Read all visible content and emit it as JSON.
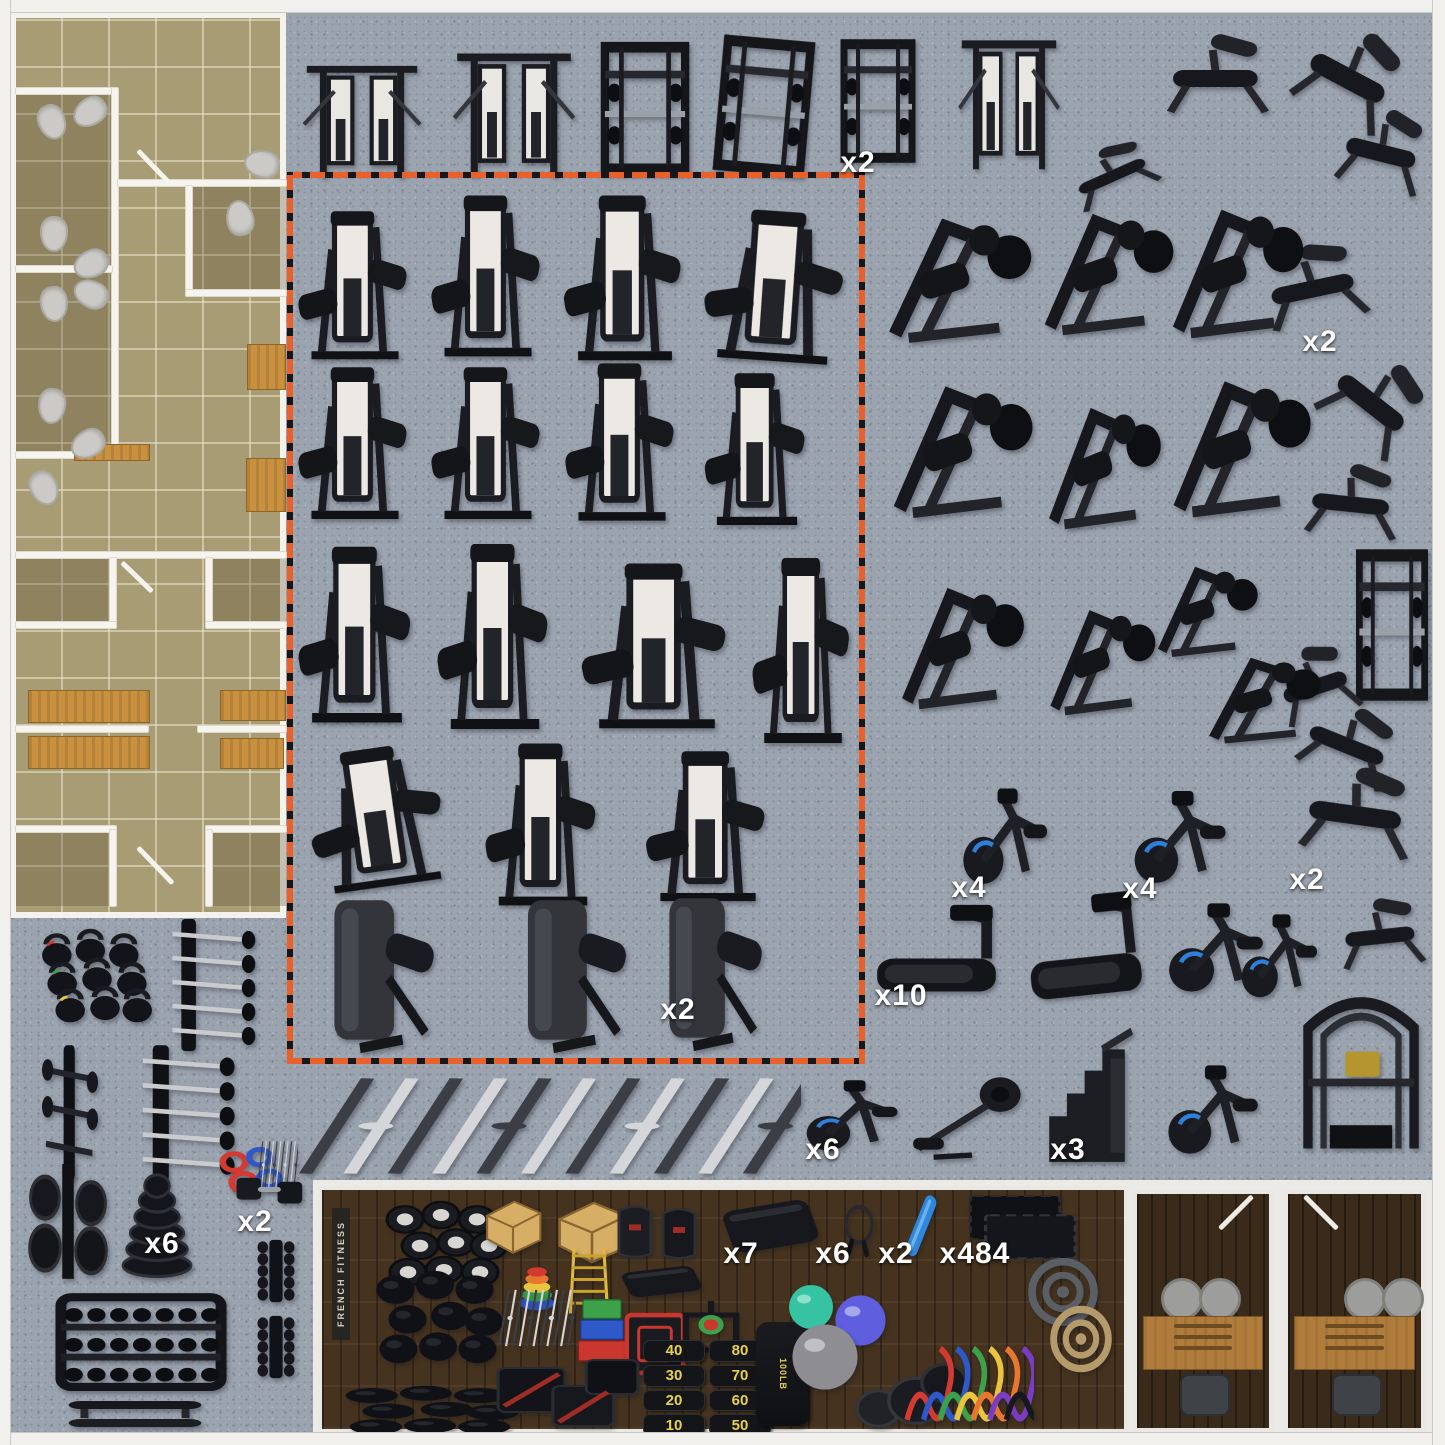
{
  "colors": {
    "carpet": "#9ba3af",
    "plan_floor": "#a89c75",
    "wall": "#f4f2ec",
    "wood_bench": "#c9913f",
    "zone_orange": "#e8612a",
    "strip_wood": "#46331f",
    "label_text": "#ffffff",
    "bike_accent": "#2e7fd9",
    "stack_white": "#eceae6"
  },
  "highlight_zone": {
    "x": 287,
    "y": 172,
    "w": 578,
    "h": 892
  },
  "bottom_strip": {
    "x": 318,
    "y": 1186,
    "w": 810,
    "h": 247,
    "brand": "FRENCH FITNESS"
  },
  "punching_bag_label": "100LB",
  "sandbags": {
    "left": [
      "40",
      "30",
      "20",
      "10"
    ],
    "right": [
      "80",
      "70",
      "60",
      "50"
    ]
  },
  "labels": [
    {
      "t": "x2",
      "x": 858,
      "y": 163
    },
    {
      "t": "x2",
      "x": 1320,
      "y": 342
    },
    {
      "t": "x4",
      "x": 969,
      "y": 888
    },
    {
      "t": "x4",
      "x": 1140,
      "y": 889
    },
    {
      "t": "x2",
      "x": 1307,
      "y": 880
    },
    {
      "t": "x2",
      "x": 678,
      "y": 1010
    },
    {
      "t": "x10",
      "x": 901,
      "y": 996
    },
    {
      "t": "x6",
      "x": 823,
      "y": 1150
    },
    {
      "t": "x3",
      "x": 1068,
      "y": 1150
    },
    {
      "t": "x6",
      "x": 162,
      "y": 1244
    },
    {
      "t": "x2",
      "x": 255,
      "y": 1222
    },
    {
      "t": "x7",
      "x": 741,
      "y": 1254
    },
    {
      "t": "x6",
      "x": 833,
      "y": 1254
    },
    {
      "t": "x2",
      "x": 896,
      "y": 1254
    },
    {
      "t": "x484",
      "x": 975,
      "y": 1254
    }
  ],
  "floorplan": {
    "rooms": [
      {
        "x": 16,
        "y": 94,
        "w": 96,
        "h": 172
      },
      {
        "x": 16,
        "y": 272,
        "w": 96,
        "h": 180
      },
      {
        "x": 192,
        "y": 186,
        "w": 94,
        "h": 104
      },
      {
        "x": 16,
        "y": 558,
        "w": 94,
        "h": 64
      },
      {
        "x": 212,
        "y": 558,
        "w": 74,
        "h": 64
      },
      {
        "x": 16,
        "y": 832,
        "w": 94,
        "h": 74
      },
      {
        "x": 212,
        "y": 832,
        "w": 74,
        "h": 74
      }
    ],
    "walls": [
      {
        "x": 16,
        "y": 88,
        "w": 100,
        "h": 6
      },
      {
        "x": 112,
        "y": 88,
        "w": 6,
        "h": 372
      },
      {
        "x": 118,
        "y": 180,
        "w": 168,
        "h": 6
      },
      {
        "x": 186,
        "y": 186,
        "w": 6,
        "h": 110
      },
      {
        "x": 186,
        "y": 290,
        "w": 100,
        "h": 6
      },
      {
        "x": 16,
        "y": 266,
        "w": 96,
        "h": 6
      },
      {
        "x": 16,
        "y": 452,
        "w": 102,
        "h": 6
      },
      {
        "x": 16,
        "y": 552,
        "w": 270,
        "h": 6
      },
      {
        "x": 110,
        "y": 558,
        "w": 6,
        "h": 70
      },
      {
        "x": 16,
        "y": 622,
        "w": 100,
        "h": 6
      },
      {
        "x": 206,
        "y": 558,
        "w": 6,
        "h": 70
      },
      {
        "x": 206,
        "y": 622,
        "w": 80,
        "h": 6
      },
      {
        "x": 16,
        "y": 726,
        "w": 132,
        "h": 6
      },
      {
        "x": 198,
        "y": 726,
        "w": 88,
        "h": 6
      },
      {
        "x": 16,
        "y": 826,
        "w": 100,
        "h": 6
      },
      {
        "x": 110,
        "y": 830,
        "w": 6,
        "h": 76
      },
      {
        "x": 206,
        "y": 826,
        "w": 80,
        "h": 6
      },
      {
        "x": 206,
        "y": 830,
        "w": 6,
        "h": 76
      }
    ],
    "benches": [
      {
        "x": 247,
        "y": 344,
        "w": 37,
        "h": 44
      },
      {
        "x": 246,
        "y": 458,
        "w": 38,
        "h": 52
      },
      {
        "x": 74,
        "y": 444,
        "w": 74,
        "h": 15
      },
      {
        "x": 28,
        "y": 690,
        "w": 120,
        "h": 31
      },
      {
        "x": 220,
        "y": 690,
        "w": 64,
        "h": 29
      },
      {
        "x": 28,
        "y": 736,
        "w": 120,
        "h": 31
      },
      {
        "x": 220,
        "y": 738,
        "w": 62,
        "h": 29
      }
    ],
    "toilets": [
      {
        "x": 38,
        "y": 104,
        "r": -20
      },
      {
        "x": 76,
        "y": 94,
        "r": 55
      },
      {
        "x": 248,
        "y": 146,
        "r": 100
      },
      {
        "x": 226,
        "y": 200,
        "r": 170
      },
      {
        "x": 40,
        "y": 216,
        "r": 0
      },
      {
        "x": 77,
        "y": 246,
        "r": 65
      },
      {
        "x": 40,
        "y": 286,
        "r": -5
      },
      {
        "x": 77,
        "y": 276,
        "r": 115
      },
      {
        "x": 38,
        "y": 388,
        "r": 5
      },
      {
        "x": 74,
        "y": 426,
        "r": 60
      },
      {
        "x": 30,
        "y": 470,
        "r": -25
      }
    ],
    "doors": [
      {
        "x": 138,
        "y": 148,
        "len": 46,
        "rot": 46
      },
      {
        "x": 122,
        "y": 560,
        "len": 42,
        "rot": 44
      },
      {
        "x": 138,
        "y": 845,
        "len": 50,
        "rot": 46
      }
    ]
  },
  "offices": [
    {
      "x": 1133,
      "y": 1190,
      "w": 140,
      "h": 242,
      "flip": false
    },
    {
      "x": 1284,
      "y": 1190,
      "w": 141,
      "h": 242,
      "flip": true
    }
  ],
  "equipment": [
    {
      "n": "functional-trainer",
      "k": "ftrainer",
      "x": 293,
      "y": 50,
      "w": 138,
      "h": 138
    },
    {
      "n": "dual-stack-functional-trainer",
      "k": "ftrainer",
      "x": 443,
      "y": 36,
      "w": 142,
      "h": 152
    },
    {
      "n": "power-rack",
      "k": "rack",
      "x": 586,
      "y": 32,
      "w": 118,
      "h": 152
    },
    {
      "n": "smith-machine",
      "k": "rack",
      "x": 703,
      "y": 28,
      "w": 122,
      "h": 156,
      "r": 5
    },
    {
      "n": "half-rack-plate-storage",
      "k": "rack",
      "x": 828,
      "y": 30,
      "w": 100,
      "h": 142
    },
    {
      "n": "cable-jungle",
      "k": "ftrainer",
      "x": 950,
      "y": 22,
      "w": 118,
      "h": 160
    },
    {
      "n": "flat-decline-bench",
      "k": "bench",
      "x": 1058,
      "y": 142,
      "w": 112,
      "h": 66,
      "r": -24
    },
    {
      "n": "ghd-machine",
      "k": "bench",
      "x": 1152,
      "y": 28,
      "w": 132,
      "h": 100
    },
    {
      "n": "ab-crunch-bench",
      "k": "bench",
      "x": 1287,
      "y": 20,
      "w": 126,
      "h": 118,
      "r": 28
    },
    {
      "n": "adjustable-incline-bench",
      "k": "bench",
      "x": 1328,
      "y": 102,
      "w": 110,
      "h": 102,
      "r": 14
    },
    {
      "n": "fid-bench",
      "k": "bench",
      "x": 1250,
      "y": 238,
      "w": 130,
      "h": 100,
      "r": -12
    },
    {
      "n": "decline-ab-bench",
      "k": "bench",
      "x": 1312,
      "y": 348,
      "w": 122,
      "h": 112,
      "r": 38
    },
    {
      "n": "flat-utility-bench",
      "k": "bench",
      "x": 1293,
      "y": 458,
      "w": 120,
      "h": 92,
      "r": 6
    },
    {
      "n": "power-tower",
      "k": "rack",
      "x": 1344,
      "y": 538,
      "w": 96,
      "h": 174
    },
    {
      "n": "roman-chair",
      "k": "bench",
      "x": 1266,
      "y": 640,
      "w": 102,
      "h": 92,
      "r": -18
    },
    {
      "n": "incline-bench",
      "k": "bench",
      "x": 1288,
      "y": 700,
      "w": 122,
      "h": 92,
      "r": 22
    },
    {
      "n": "olympic-flat-bench",
      "k": "bench",
      "x": 1286,
      "y": 760,
      "w": 144,
      "h": 110,
      "r": 8
    },
    {
      "n": "seated-utility-bench",
      "k": "bench",
      "x": 1328,
      "y": 893,
      "w": 108,
      "h": 86,
      "r": -6
    },
    {
      "n": "iso-lateral-leg-press",
      "k": "plate",
      "x": 875,
      "y": 190,
      "w": 168,
      "h": 168
    },
    {
      "n": "linear-leg-press",
      "k": "plate",
      "x": 1032,
      "y": 186,
      "w": 152,
      "h": 164
    },
    {
      "n": "hack-squat-machine",
      "k": "plate",
      "x": 1160,
      "y": 180,
      "w": 154,
      "h": 174
    },
    {
      "n": "belt-squat-machine",
      "k": "plate",
      "x": 880,
      "y": 356,
      "w": 164,
      "h": 178
    },
    {
      "n": "iso-lateral-row-machine",
      "k": "plate",
      "x": 1038,
      "y": 380,
      "w": 132,
      "h": 164
    },
    {
      "n": "iso-lateral-bench-press",
      "k": "plate",
      "x": 1160,
      "y": 350,
      "w": 162,
      "h": 184
    },
    {
      "n": "pendulum-squat",
      "k": "plate",
      "x": 890,
      "y": 560,
      "w": 144,
      "h": 164
    },
    {
      "n": "seated-calf-machine",
      "k": "plate",
      "x": 1040,
      "y": 586,
      "w": 124,
      "h": 142
    },
    {
      "n": "t-bar-row",
      "k": "plate",
      "x": 1148,
      "y": 546,
      "w": 118,
      "h": 122
    },
    {
      "n": "glute-drive-machine",
      "k": "plate",
      "x": 1198,
      "y": 638,
      "w": 132,
      "h": 116
    },
    {
      "n": "upright-bike",
      "k": "bike",
      "x": 948,
      "y": 772,
      "w": 118,
      "h": 138
    },
    {
      "n": "recumbent-bike",
      "k": "bike",
      "x": 1118,
      "y": 775,
      "w": 128,
      "h": 133
    },
    {
      "n": "treadmill",
      "k": "tread",
      "x": 862,
      "y": 900,
      "w": 152,
      "h": 122
    },
    {
      "n": "curved-treadmill",
      "k": "tread",
      "x": 1015,
      "y": 890,
      "w": 142,
      "h": 140,
      "r": -6
    },
    {
      "n": "seated-climber",
      "k": "bike",
      "x": 1152,
      "y": 888,
      "w": 132,
      "h": 128
    },
    {
      "n": "spin-bike",
      "k": "bike",
      "x": 1228,
      "y": 900,
      "w": 106,
      "h": 120
    },
    {
      "n": "elliptical-trainer",
      "k": "bike",
      "x": 790,
      "y": 1068,
      "w": 128,
      "h": 102
    },
    {
      "n": "air-rower",
      "k": "rower",
      "x": 908,
      "y": 1060,
      "w": 128,
      "h": 108
    },
    {
      "n": "stair-climber",
      "k": "climber",
      "x": 1028,
      "y": 1022,
      "w": 118,
      "h": 152
    },
    {
      "n": "air-bike",
      "k": "bike",
      "x": 1152,
      "y": 1050,
      "w": 126,
      "h": 128
    },
    {
      "n": "ff-multi-rig",
      "k": "rig",
      "x": 1283,
      "y": 970,
      "w": 156,
      "h": 194
    },
    {
      "n": "seated-row-machine",
      "k": "sel",
      "x": 291,
      "y": 208,
      "w": 128,
      "h": 160
    },
    {
      "n": "standing-leg-curl-machine",
      "k": "sel",
      "x": 424,
      "y": 192,
      "w": 128,
      "h": 174
    },
    {
      "n": "shoulder-press-machine",
      "k": "sel",
      "x": 556,
      "y": 192,
      "w": 138,
      "h": 178
    },
    {
      "n": "leg-extension-machine",
      "k": "sel",
      "x": 696,
      "y": 208,
      "w": 162,
      "h": 162,
      "r": 4
    },
    {
      "n": "pec-fly-machine",
      "k": "sel",
      "x": 291,
      "y": 364,
      "w": 128,
      "h": 164
    },
    {
      "n": "hip-adduction-machine",
      "k": "sel",
      "x": 424,
      "y": 364,
      "w": 128,
      "h": 164
    },
    {
      "n": "lat-pulldown-machine",
      "k": "sel",
      "x": 558,
      "y": 360,
      "w": 128,
      "h": 170
    },
    {
      "n": "seated-dip-machine",
      "k": "sel",
      "x": 698,
      "y": 370,
      "w": 118,
      "h": 164
    },
    {
      "n": "multi-press-machine",
      "k": "sel",
      "x": 291,
      "y": 543,
      "w": 132,
      "h": 190
    },
    {
      "n": "glute-kickback-machine",
      "k": "sel",
      "x": 430,
      "y": 540,
      "w": 130,
      "h": 200
    },
    {
      "n": "ab-crunch-machine",
      "k": "sel",
      "x": 572,
      "y": 560,
      "w": 170,
      "h": 178
    },
    {
      "n": "dip-chin-assist-machine",
      "k": "sel",
      "x": 746,
      "y": 554,
      "w": 114,
      "h": 200
    },
    {
      "n": "seated-leg-press-machine",
      "k": "sel",
      "x": 300,
      "y": 745,
      "w": 158,
      "h": 150,
      "r": -8
    },
    {
      "n": "back-extension-machine",
      "k": "sel",
      "x": 478,
      "y": 740,
      "w": 130,
      "h": 175
    },
    {
      "n": "preacher-curl-machine",
      "k": "sel",
      "x": 638,
      "y": 748,
      "w": 140,
      "h": 162
    },
    {
      "n": "converging-chest-press",
      "k": "shroud",
      "x": 306,
      "y": 890,
      "w": 142,
      "h": 170
    },
    {
      "n": "pec-dec-machine",
      "k": "shroud",
      "x": 500,
      "y": 890,
      "w": 140,
      "h": 170
    },
    {
      "n": "tricep-extension-machine",
      "k": "shroud",
      "x": 643,
      "y": 888,
      "w": 132,
      "h": 170
    },
    {
      "n": "kettlebell-set",
      "k": "kbell",
      "x": 30,
      "y": 920,
      "w": 134,
      "h": 110
    },
    {
      "n": "fixed-barbell-rack",
      "k": "rackbars",
      "x": 150,
      "y": 910,
      "w": 112,
      "h": 150
    },
    {
      "n": "accessory-tree",
      "k": "tree",
      "x": 30,
      "y": 1036,
      "w": 80,
      "h": 154
    },
    {
      "n": "ez-barbell-rack",
      "k": "rackbars",
      "x": 118,
      "y": 1036,
      "w": 124,
      "h": 154
    },
    {
      "n": "plate-tree",
      "k": "ptree",
      "x": 20,
      "y": 1150,
      "w": 96,
      "h": 140
    },
    {
      "n": "bumper-plate-stack",
      "k": "pstack",
      "x": 112,
      "y": 1160,
      "w": 90,
      "h": 124
    },
    {
      "n": "barbell-collars",
      "k": "collars",
      "x": 210,
      "y": 1144,
      "w": 80,
      "h": 60
    },
    {
      "n": "cable-attachments",
      "k": "bars",
      "x": 256,
      "y": 1138,
      "w": 42,
      "h": 54
    },
    {
      "n": "hex-dumbbell-pair",
      "k": "hexdb",
      "x": 230,
      "y": 1160,
      "w": 82,
      "h": 64
    },
    {
      "n": "vertical-dumbbell-rack",
      "k": "dbtower",
      "x": 243,
      "y": 1234,
      "w": 66,
      "h": 74
    },
    {
      "n": "vertical-dumbbell-rack-2",
      "k": "dbtower",
      "x": 243,
      "y": 1310,
      "w": 66,
      "h": 74
    },
    {
      "n": "three-tier-dumbbell-rack",
      "k": "dbrack",
      "x": 50,
      "y": 1270,
      "w": 182,
      "h": 136
    },
    {
      "n": "flat-bench-stack",
      "k": "benchpair",
      "x": 56,
      "y": 1390,
      "w": 158,
      "h": 50
    },
    {
      "n": "specialty-barbell-set",
      "k": "bars",
      "x": 285,
      "y": 1072,
      "w": 516,
      "h": 108
    },
    {
      "n": "medicine-ball-pyramid",
      "k": "ballsm",
      "x": 372,
      "y": 1193,
      "w": 150,
      "h": 110
    },
    {
      "n": "slam-ball-pyramid",
      "k": "ballsd",
      "x": 362,
      "y": 1260,
      "w": 152,
      "h": 114
    },
    {
      "n": "wall-ball-row",
      "k": "ballsd",
      "x": 326,
      "y": 1380,
      "w": 208,
      "h": 60
    },
    {
      "n": "wooden-plyo-box",
      "k": "woodbox",
      "x": 477,
      "y": 1194,
      "w": 72,
      "h": 64
    },
    {
      "n": "jerk-blocks",
      "k": "woodbox",
      "x": 547,
      "y": 1194,
      "w": 90,
      "h": 74
    },
    {
      "n": "weighted-vests",
      "k": "vests",
      "x": 607,
      "y": 1198,
      "w": 100,
      "h": 66
    },
    {
      "n": "yoga-mats",
      "k": "mat",
      "x": 716,
      "y": 1190,
      "w": 110,
      "h": 74
    },
    {
      "n": "jump-ropes",
      "k": "jrope",
      "x": 834,
      "y": 1196,
      "w": 50,
      "h": 68
    },
    {
      "n": "foam-roller",
      "k": "roller",
      "x": 898,
      "y": 1194,
      "w": 54,
      "h": 72
    },
    {
      "n": "rubber-floor-tiles",
      "k": "tiles",
      "x": 960,
      "y": 1188,
      "w": 128,
      "h": 80
    },
    {
      "n": "agility-cones",
      "k": "cones",
      "x": 508,
      "y": 1258,
      "w": 58,
      "h": 58
    },
    {
      "n": "agility-ladder",
      "k": "ladder",
      "x": 558,
      "y": 1244,
      "w": 62,
      "h": 74
    },
    {
      "n": "aerobic-stepper",
      "k": "mat",
      "x": 616,
      "y": 1260,
      "w": 92,
      "h": 44
    },
    {
      "n": "farmer-carry-handles",
      "k": "bars",
      "x": 496,
      "y": 1286,
      "w": 80,
      "h": 64
    },
    {
      "n": "stacked-plyo-boxes",
      "k": "boxstack",
      "x": 574,
      "y": 1294,
      "w": 56,
      "h": 72
    },
    {
      "n": "steel-plyo-box",
      "k": "steelbox",
      "x": 618,
      "y": 1306,
      "w": 74,
      "h": 76
    },
    {
      "n": "weight-sled",
      "k": "sled",
      "x": 666,
      "y": 1294,
      "w": 90,
      "h": 70
    },
    {
      "n": "soft-plyo-boxes",
      "k": "softbox",
      "x": 492,
      "y": 1342,
      "w": 152,
      "h": 100
    },
    {
      "n": "sandbag-set",
      "k": "sandbags",
      "x": 643,
      "y": 1340,
      "w": 128,
      "h": 96
    },
    {
      "n": "punching-bag",
      "k": "pbag",
      "x": 756,
      "y": 1322,
      "w": 54,
      "h": 104
    },
    {
      "n": "stability-ball-green",
      "k": "ball",
      "c": "#35c3a2",
      "x": 786,
      "y": 1282,
      "w": 50,
      "h": 50
    },
    {
      "n": "stability-ball-purple",
      "k": "ball",
      "c": "#5e5ede",
      "x": 832,
      "y": 1292,
      "w": 57,
      "h": 57
    },
    {
      "n": "stability-ball-silver",
      "k": "ball",
      "c": "#8d8d92",
      "x": 788,
      "y": 1320,
      "w": 74,
      "h": 74
    },
    {
      "n": "round-plyo-ottomans",
      "k": "ottoman",
      "x": 850,
      "y": 1340,
      "w": 118,
      "h": 98
    },
    {
      "n": "battle-rope-coil",
      "k": "coil",
      "c": "#5a5f66",
      "x": 1020,
      "y": 1250,
      "w": 86,
      "h": 84
    },
    {
      "n": "climbing-rope-coil",
      "k": "coil",
      "c": "#b59a6b",
      "x": 1043,
      "y": 1298,
      "w": 76,
      "h": 82
    },
    {
      "n": "resistance-band-set",
      "k": "bands",
      "x": 896,
      "y": 1274,
      "w": 138,
      "h": 162
    }
  ]
}
